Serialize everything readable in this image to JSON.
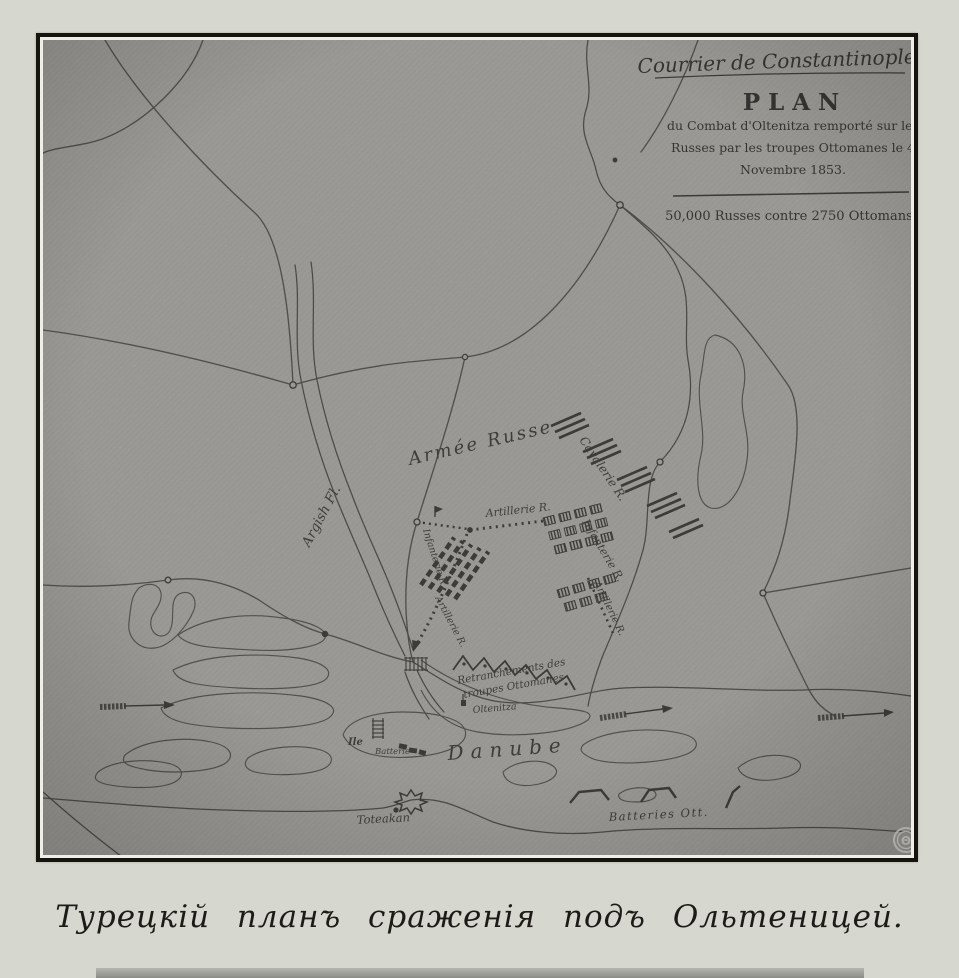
{
  "page": {
    "caption": "Турецкій планъ сраженія подъ Ольтеницей."
  },
  "cartouche": {
    "newspaper": "Courrier de Constantinople.",
    "plan": "PLAN",
    "line1": "du Combat d'Oltenitza remporté sur les",
    "line2": "Russes par les troupes Ottomanes  le 4",
    "line3": "Novembre 1853.",
    "forces": "50,000 Russes contre 2750 Ottomans."
  },
  "labels": {
    "armee_russe": "Armée Russe",
    "cavalerie": "Cavalerie R.",
    "artillerie_center": "Artillerie R.",
    "infanterie_right": "Infanterie R.",
    "artillerie_right": "Artillerie R.",
    "infanterie_left": "Infanterie R.",
    "artillerie_column": "Artillerie R.",
    "argish": "Argish Fl.",
    "retranchements_line1": "Retranchements des",
    "retranchements_line2": "troupes Ottomanes",
    "oltenitza": "Oltenitza",
    "danube": "Danube",
    "ile": "Ile",
    "batterie": "Batterie",
    "toteakan": "Toteakan",
    "batteries_ott": "Batteries Ott.",
    "watermark": "Θ"
  },
  "colors": {
    "paper": "#d6d7cf",
    "map_base": "#a9a8a2",
    "ink": "#2f2d28"
  }
}
